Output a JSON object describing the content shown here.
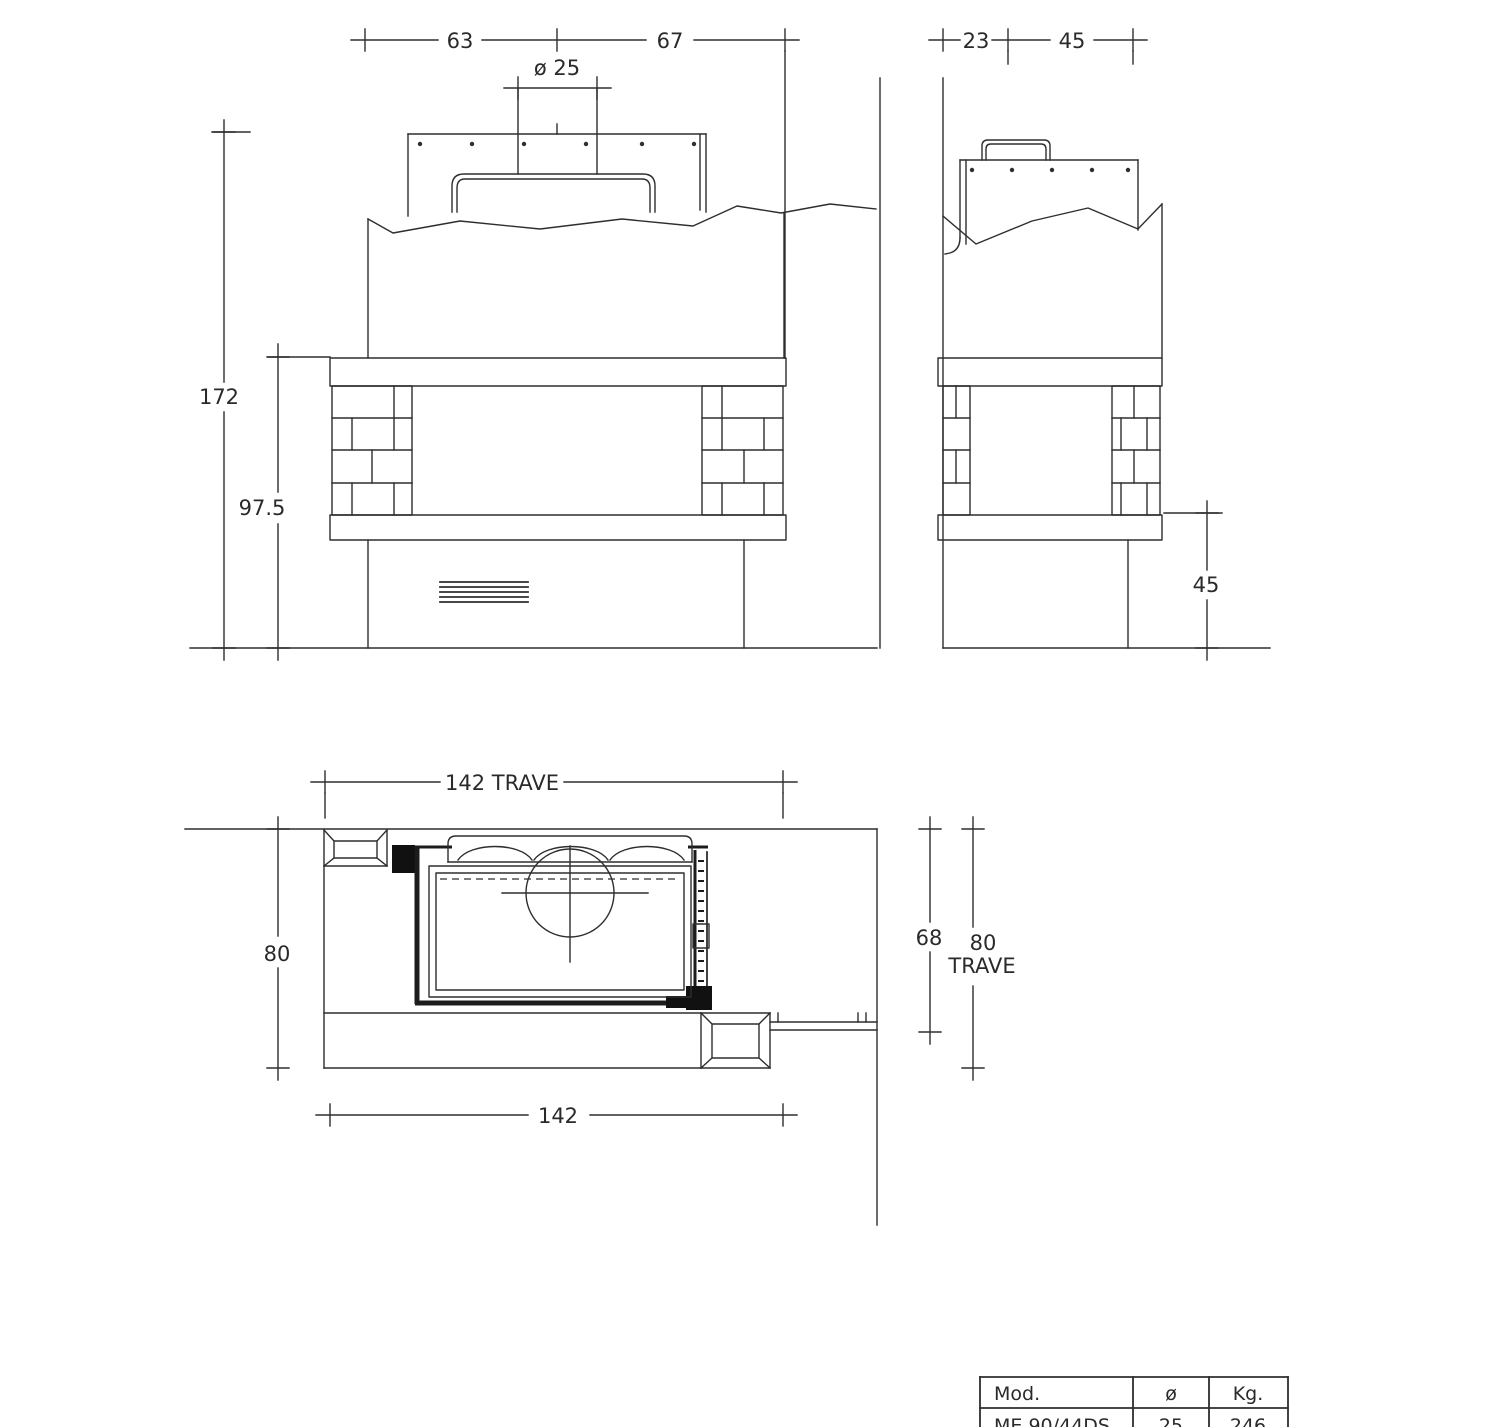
{
  "front_view": {
    "width_left": "63",
    "width_right": "67",
    "flue": "ø 25",
    "total_height": "172",
    "opening_height": "97.5"
  },
  "side_view": {
    "depth_rear": "23",
    "depth_front": "45",
    "hearth_height": "45"
  },
  "plan_view": {
    "beam_width": "142  TRAVE",
    "depth": "80",
    "width": "142",
    "inner_depth": "68",
    "beam_depth": "80",
    "beam_word": "TRAVE"
  },
  "spec_table": {
    "header_model": "Mod.",
    "header_diameter": "ø",
    "header_weight": "Kg.",
    "row_model": "ME 90/44DS",
    "row_diameter": "25",
    "row_weight": "246"
  }
}
